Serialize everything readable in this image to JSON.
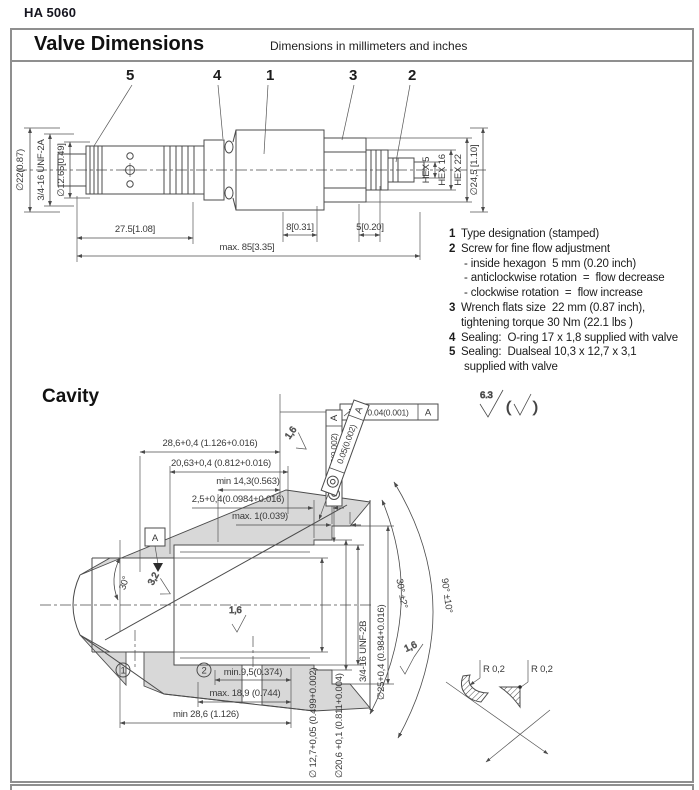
{
  "page": {
    "doc_code": "HA 5060",
    "title": "Valve Dimensions",
    "subtitle": "Dimensions in millimeters and inches",
    "cavity_title": "Cavity"
  },
  "valve": {
    "callouts": [
      "5",
      "4",
      "1",
      "3",
      "2"
    ],
    "dia_22": "∅22(0.87)",
    "thread": "3/4-16 UNF-2A",
    "dia_1265": "∅12.65[0.49]",
    "hex_5": "HEX 5",
    "hex_16": "HEX 16",
    "hex_22": "HEX 22",
    "dia_245": "∅24,5 [1.10]",
    "len_275": "27.5[1.08]",
    "len_8": "8[0.31]",
    "len_5": "5[0.20]",
    "len_85": "max. 85[3.35]"
  },
  "notes": {
    "rows": [
      {
        "num": "1",
        "text": "Type designation (stamped)"
      },
      {
        "num": "2",
        "text": "Screw for fine flow adjustment"
      },
      {
        "num": "",
        "text": " - inside hexagon  5 mm (0.20 inch)"
      },
      {
        "num": "",
        "text": " - anticlockwise rotation  =  flow decrease"
      },
      {
        "num": "",
        "text": " - clockwise rotation  =  flow increase"
      },
      {
        "num": "3",
        "text": "Wrench flats size  22 mm (0.87 inch),"
      },
      {
        "num": "",
        "text": "tightening torque 30 Nm (22.1 lbs )"
      },
      {
        "num": "4",
        "text": "Sealing:  O-ring 17 x 1,8 supplied with valve"
      },
      {
        "num": "5",
        "text": "Sealing:  Dualseal 10,3 x 12,7 x 3,1"
      },
      {
        "num": "",
        "text": " supplied with valve"
      }
    ]
  },
  "cavity": {
    "surface_finish": "6.3",
    "datum": "A",
    "frames": {
      "runout_value": "0.04(0.001)",
      "runout_datum": "A",
      "conc1_value": "0.05(0.002)",
      "conc1_datum": "A",
      "conc2_value": "0.05(0.002)",
      "conc2_datum": "A"
    },
    "dims": {
      "d286": "28,6+0,4 (1.126+0.016)",
      "d2063": "20,63+0,4 (0.812+0.016)",
      "d143": "min 14,3(0.563)",
      "d25": "2,5+0,4(0.0984+0.016)",
      "dmax1": "max. 1(0.039)",
      "thread": "3/4-16 UNF-2B",
      "dia25": "∅25+0,4 (0.984+0.016)",
      "dia127": "∅ 12,7+0,05 (0.499+0.002)",
      "dia206": "∅20,6 +0,1 (0.811+0.004)",
      "d95": "min.9,5(0.374)",
      "d189": "max. 18,9 (0.744)",
      "d286b": "min 28,6 (1.126)"
    },
    "angles": {
      "a30": "30°",
      "a30t": "30° ±2°",
      "a90t": "90° ±10°"
    },
    "roughness": {
      "r16a": "1,6",
      "r32": "3,2",
      "r16b": "1,6",
      "r16c": "1,6"
    },
    "radii": {
      "r1": "R 0,2",
      "r2": "R 0,2"
    },
    "ports": {
      "p1": "1",
      "p2": "2"
    }
  }
}
